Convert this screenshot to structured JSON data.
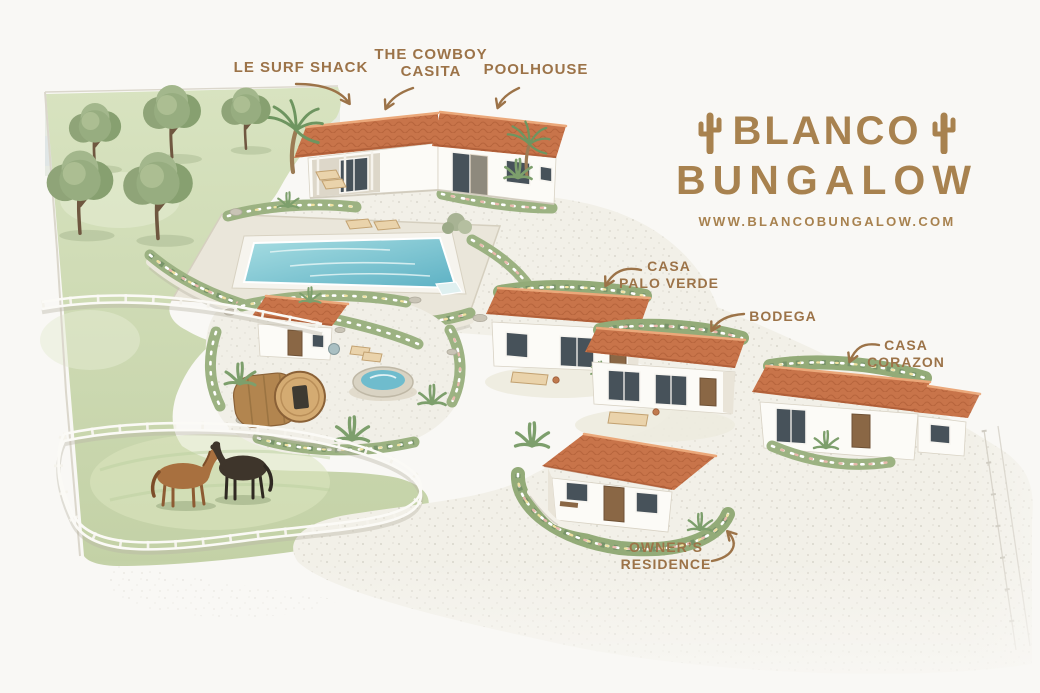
{
  "window": {
    "kind": "illustrated resort property map"
  },
  "logo": {
    "line1": "BLANCO",
    "line2": "BUNGALOW",
    "website": "WWW.BLANCOBUNGALOW.COM",
    "color": "#A8824F",
    "icons": [
      "cactus-icon",
      "cactus-icon"
    ]
  },
  "building_labels": {
    "surf_shack": "LE SURF SHACK",
    "cowboy_casita_line1": "THE COWBOY",
    "cowboy_casita_line2": "CASITA",
    "poolhouse": "POOLHOUSE",
    "casa_palo_verde_line1": "CASA",
    "casa_palo_verde_line2": "PALO VERDE",
    "bodega": "BODEGA",
    "casa_corazon_line1": "CASA",
    "casa_corazon_line2": "CORAZON",
    "owners_residence_line1": "OWNER’S",
    "owners_residence_line2": "RESIDENCE"
  },
  "scene": {
    "features": [
      "olive tree grove",
      "long guest building with shaded porch and loungers",
      "rectangular swimming pool with stone sun deck",
      "spa garden with small casita, barrel sauna and round plunge tub",
      "row of three white casitas with terracotta roofs",
      "owner's residence cottage with walled patio garden",
      "horse paddock with two horses",
      "white rail fencing",
      "gravel drive and paths"
    ],
    "colors": {
      "label_text": "#9C7348",
      "roof_terracotta": "#C8744A",
      "pool_water": "#7FC6D4",
      "lawn": "#CCD9AE",
      "paper": "#F9F8F5"
    }
  }
}
